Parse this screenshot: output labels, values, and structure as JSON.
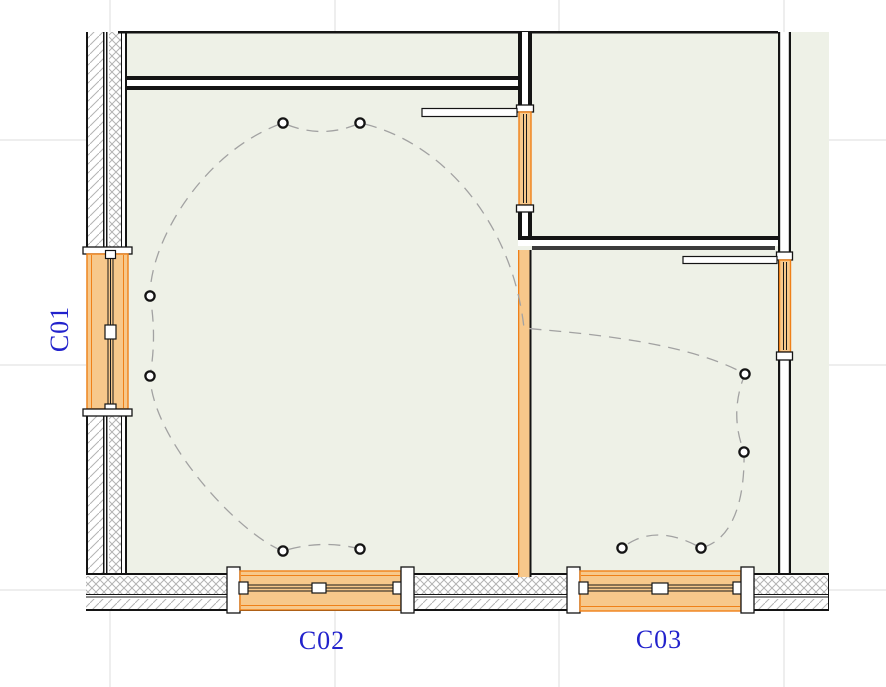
{
  "drawing": {
    "type": "architectural-floor-plan",
    "labels": {
      "c01": "C01",
      "c02": "C02",
      "c03": "C03"
    },
    "colors": {
      "bg": "#ffffff",
      "floor": "#eef1e7",
      "wall": "#141414",
      "hatch": "#b3b3b3",
      "grid": "#dcdcdc",
      "winfill": "#f7c88b",
      "winborder": "#ef8018",
      "wire": "#a2a2a2",
      "label": "#2222cc"
    },
    "grid_v": [
      110,
      335,
      559,
      784
    ],
    "grid_h": [
      140,
      365,
      590
    ],
    "lights": [
      [
        283,
        123
      ],
      [
        360,
        123
      ],
      [
        150,
        296
      ],
      [
        150,
        376
      ],
      [
        283,
        551
      ],
      [
        360,
        549
      ],
      [
        745,
        374
      ],
      [
        744,
        452
      ],
      [
        701,
        548
      ],
      [
        622,
        548
      ]
    ],
    "light_radius": 4.6,
    "wiring_path": "M 360,549 Q 322,539 283,551 C 240,535 152,440 150,376 Q 157,336 150,296 C 150,240 205,150 283,123 Q 322,140 360,123 C 440,140 512,220 524,328 C 560,332 680,338 745,374 Q 729,413 744,452 C 745,500 733,540 701,548 Q 655,522 622,548"
  }
}
